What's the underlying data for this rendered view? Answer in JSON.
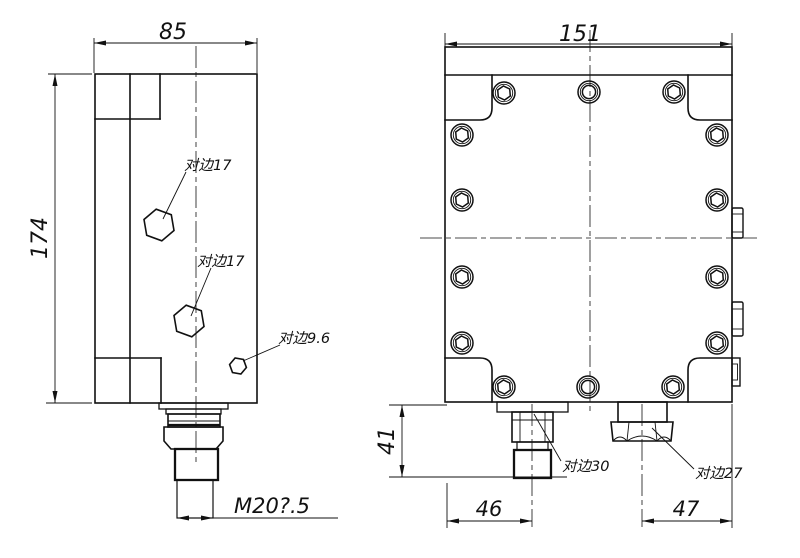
{
  "colors": {
    "line": "#111111",
    "background": "#ffffff"
  },
  "front_view": {
    "width_dim": "85",
    "height_dim": "174",
    "thread_dim": "M20?.5",
    "labels": {
      "hex_top": "对边17",
      "hex_mid": "对边17",
      "hex_small": "对边9.6"
    }
  },
  "side_view": {
    "width_dim": "151",
    "height_dim": "41",
    "offset_left_dim": "46",
    "offset_right_dim": "47",
    "labels": {
      "port_left": "对边30",
      "port_right": "对边27"
    }
  }
}
